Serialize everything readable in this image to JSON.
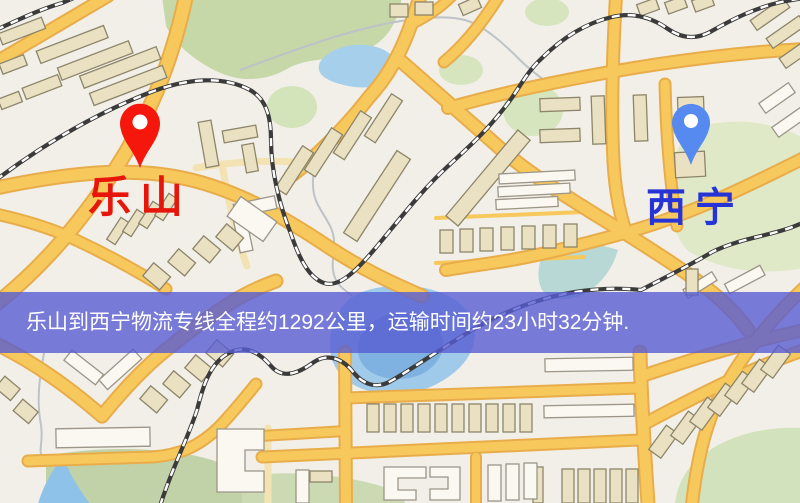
{
  "map": {
    "origin": {
      "label": "乐山",
      "pin_color": "#f5170b",
      "label_color": "#e8150b"
    },
    "destination": {
      "label": "西宁",
      "pin_color": "#568af0",
      "label_color": "#2633d6"
    },
    "banner": {
      "text": "乐山到西宁物流专线全程约1292公里，运输时间约23小时32分钟.",
      "background_color": "#585cd2",
      "text_color": "#ffffff"
    },
    "route": {
      "from": "乐山",
      "to": "西宁",
      "distance_text": "约1292公里",
      "duration_text": "约23小时32分钟"
    }
  },
  "palette": {
    "map_background": "#f2efe8",
    "road": "#f7c95c",
    "railway": "#3b3b3b",
    "park": "#ccdcae",
    "water": "#a3cce9"
  }
}
